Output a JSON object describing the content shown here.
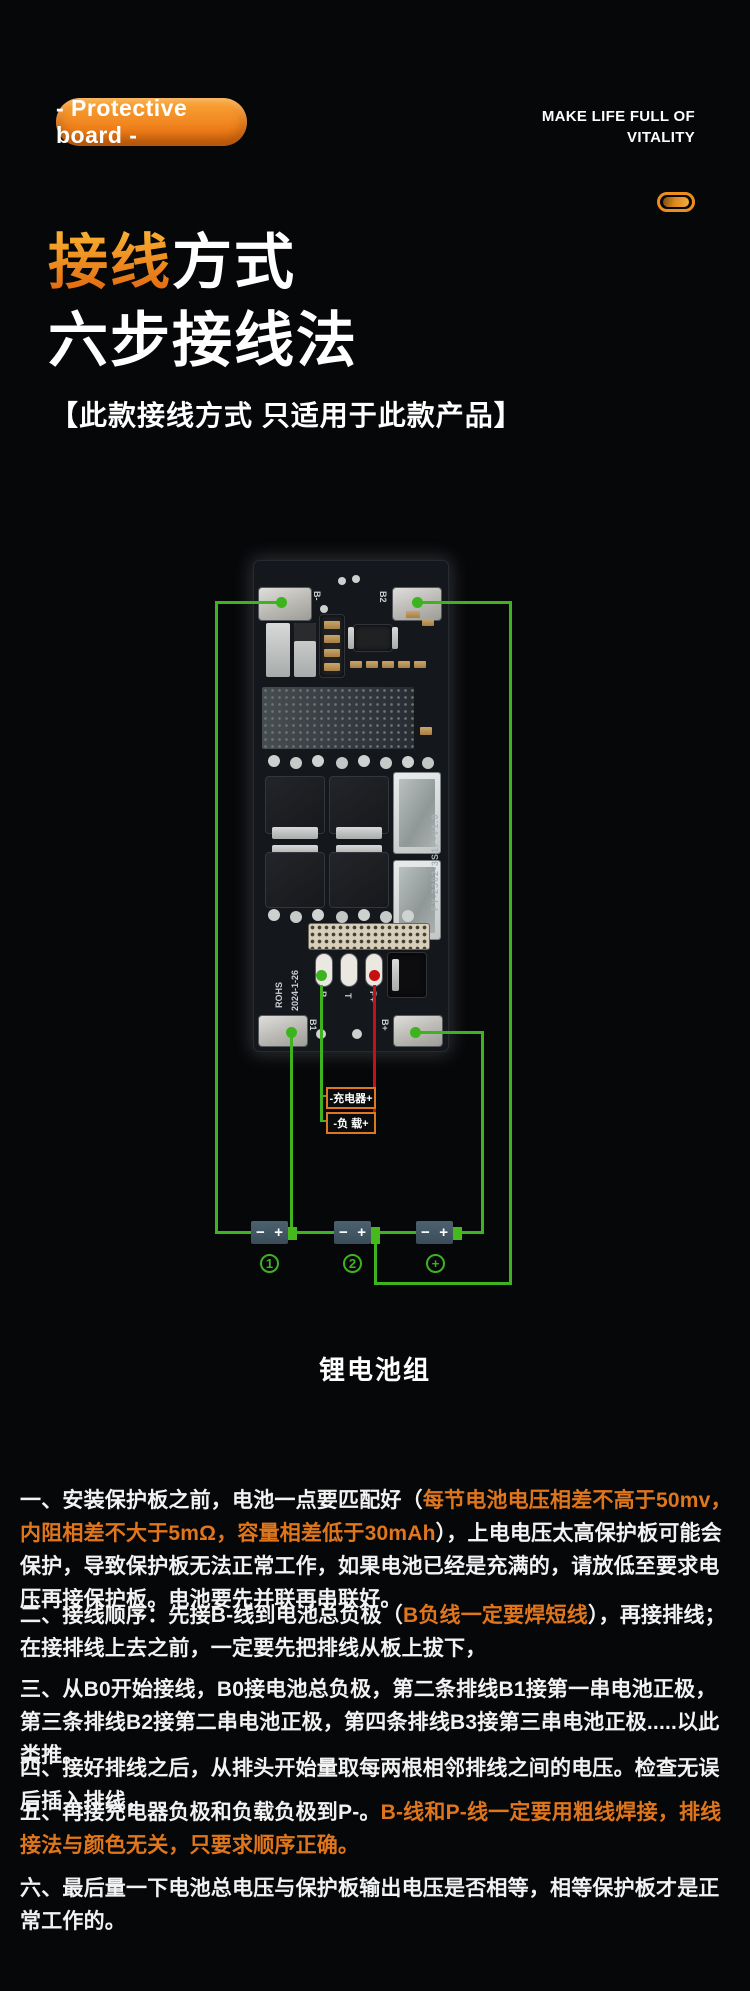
{
  "header": {
    "badge_label": "- Protective board -",
    "slogan_line1": "MAKE LIFE FULL OF",
    "slogan_line2": "VITALITY"
  },
  "title": {
    "line1_highlight": "接线",
    "line1_rest": "方式",
    "line2": "六步接线法",
    "subtitle": "【此款接线方式 只适用于此款产品】"
  },
  "diagram": {
    "board": {
      "pad_top_left": "B-",
      "pad_top_right": "B2",
      "pad_bottom_left": "B1",
      "pad_bottom_right": "B+",
      "pad_p_minus": "P-",
      "pad_t": "T",
      "pad_p_plus": "P+",
      "silk_date": "2024-1-26",
      "silk_rohs": "ROHS",
      "silk_model": "FY-2302-3S1P-V1.0"
    },
    "charger_label": "-充电器+",
    "load_label": "-负 载+",
    "cells": [
      {
        "minus": "−",
        "plus": "+"
      },
      {
        "minus": "−",
        "plus": "+"
      },
      {
        "minus": "−",
        "plus": "+"
      }
    ],
    "cell_numbers": [
      "1",
      "2",
      "+"
    ],
    "caption": "锂电池组",
    "colors": {
      "wire_green": "#3db41f",
      "wire_red": "#c41111",
      "label_border_orange": "#dd7722"
    }
  },
  "instructions": [
    {
      "segments": [
        {
          "c": "w",
          "t": "一、安装保护板之前，电池一点要匹配好（"
        },
        {
          "c": "o",
          "t": "每节电池电压相差不高于50mv，内阻相差不大于5mΩ，容量相差低于30mAh"
        },
        {
          "c": "w",
          "t": "），上电电压太高保护板可能会保护，导致保护板无法正常工作，如果电池已经是充满的，请放低至要求电压再接保护板。电池要先并联再串联好。"
        }
      ]
    },
    {
      "segments": [
        {
          "c": "w",
          "t": "二、接线顺序：先接B-线到电池总负极（"
        },
        {
          "c": "o",
          "t": "B负线一定要焊短线"
        },
        {
          "c": "w",
          "t": "），再接排线；在接排线上去之前，一定要先把排线从板上拔下，"
        }
      ]
    },
    {
      "segments": [
        {
          "c": "w",
          "t": "三、从B0开始接线，B0接电池总负极，第二条排线B1接第一串电池正极，第三条排线B2接第二串电池正极，第四条排线B3接第三串电池正极.....以此类推。"
        }
      ]
    },
    {
      "segments": [
        {
          "c": "w",
          "t": "四、接好排线之后，从排头开始量取每两根相邻排线之间的电压。检查无误后插入排线，"
        }
      ]
    },
    {
      "segments": [
        {
          "c": "w",
          "t": "五、再接充电器负极和负载负极到P-。"
        },
        {
          "c": "o",
          "t": "B-线和P-线一定要用粗线焊接，排线接法与颜色无关，只要求顺序正确。"
        }
      ]
    },
    {
      "segments": [
        {
          "c": "w",
          "t": "六、最后量一下电池总电压与保护板输出电压是否相等，相等保护板才是正常工作的。"
        }
      ]
    }
  ]
}
